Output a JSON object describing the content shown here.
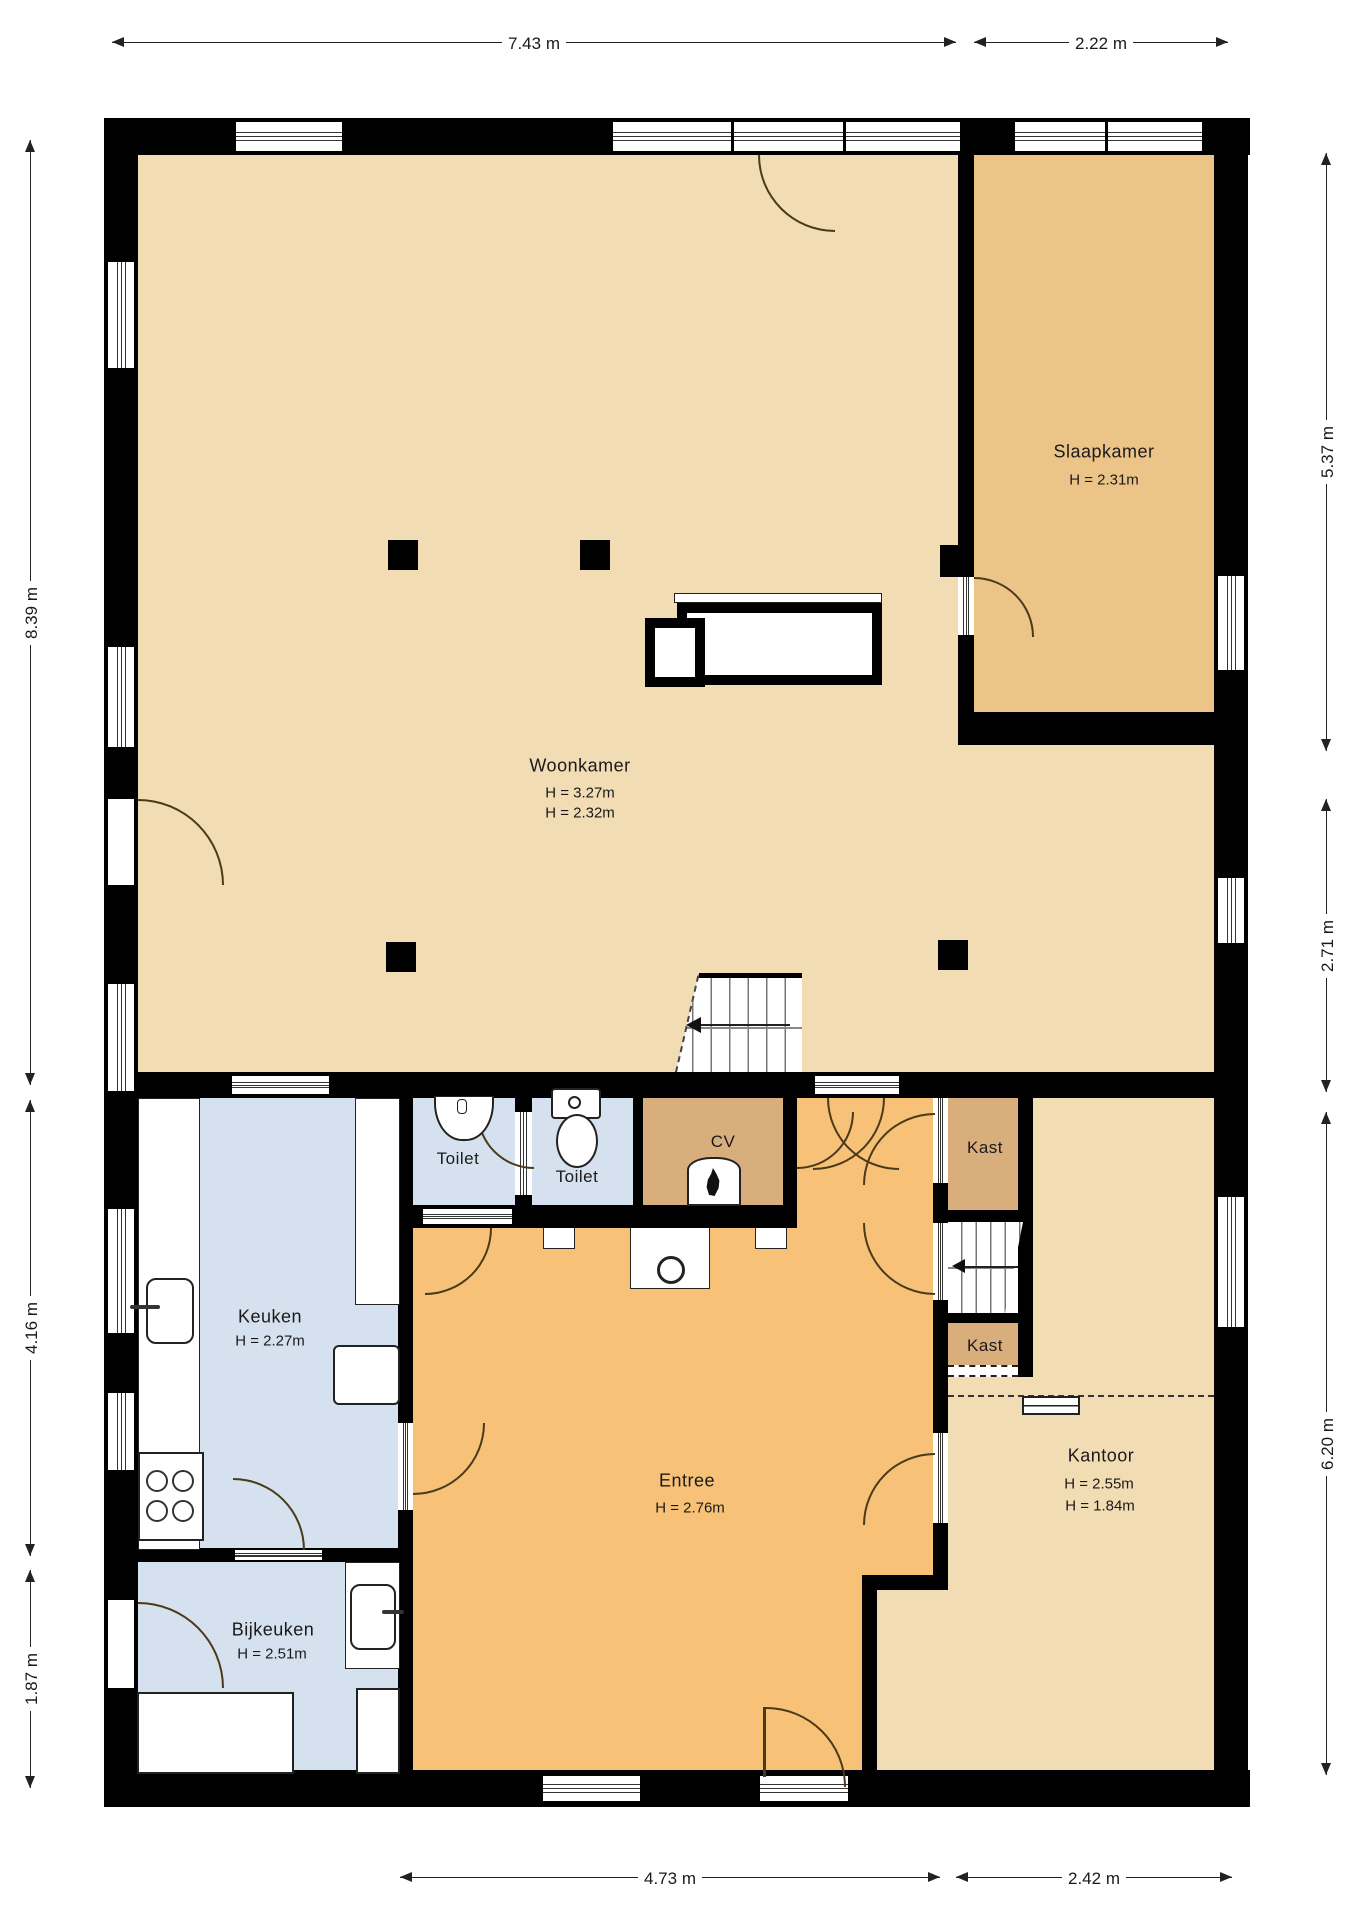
{
  "plan_type": "floor-plan",
  "rooms": {
    "woonkamer": {
      "name": "Woonkamer",
      "h1": "H = 3.27m",
      "h2": "H = 2.32m"
    },
    "slaapkamer": {
      "name": "Slaapkamer",
      "h": "H = 2.31m"
    },
    "keuken": {
      "name": "Keuken",
      "h": "H = 2.27m"
    },
    "toilet1": {
      "name": "Toilet"
    },
    "toilet2": {
      "name": "Toilet"
    },
    "cv": {
      "name": "CV"
    },
    "kast1": {
      "name": "Kast"
    },
    "kast2": {
      "name": "Kast"
    },
    "entree": {
      "name": "Entree",
      "h": "H = 2.76m"
    },
    "kantoor": {
      "name": "Kantoor",
      "h1": "H = 2.55m",
      "h2": "H = 1.84m"
    },
    "bijkeuken": {
      "name": "Bijkeuken",
      "h": "H = 2.51m"
    }
  },
  "dimensions": {
    "top": {
      "d1": "7.43 m",
      "d2": "2.22 m"
    },
    "bottom": {
      "d1": "4.73 m",
      "d2": "2.42 m"
    },
    "left": {
      "d1": "8.39 m",
      "d2": "4.16 m",
      "d3": "1.87 m"
    },
    "right": {
      "d1": "5.37 m",
      "d2": "2.71 m",
      "d3": "6.20 m"
    }
  },
  "colors": {
    "wall": "#000000",
    "living": "#f2dcb3",
    "bedroom": "#ecc488",
    "entry": "#f7c277",
    "wet": "#d5e1ee",
    "closet": "#d8ae7d",
    "paper": "#ffffff",
    "line": "#222222",
    "arc": "#4a3a1a"
  }
}
